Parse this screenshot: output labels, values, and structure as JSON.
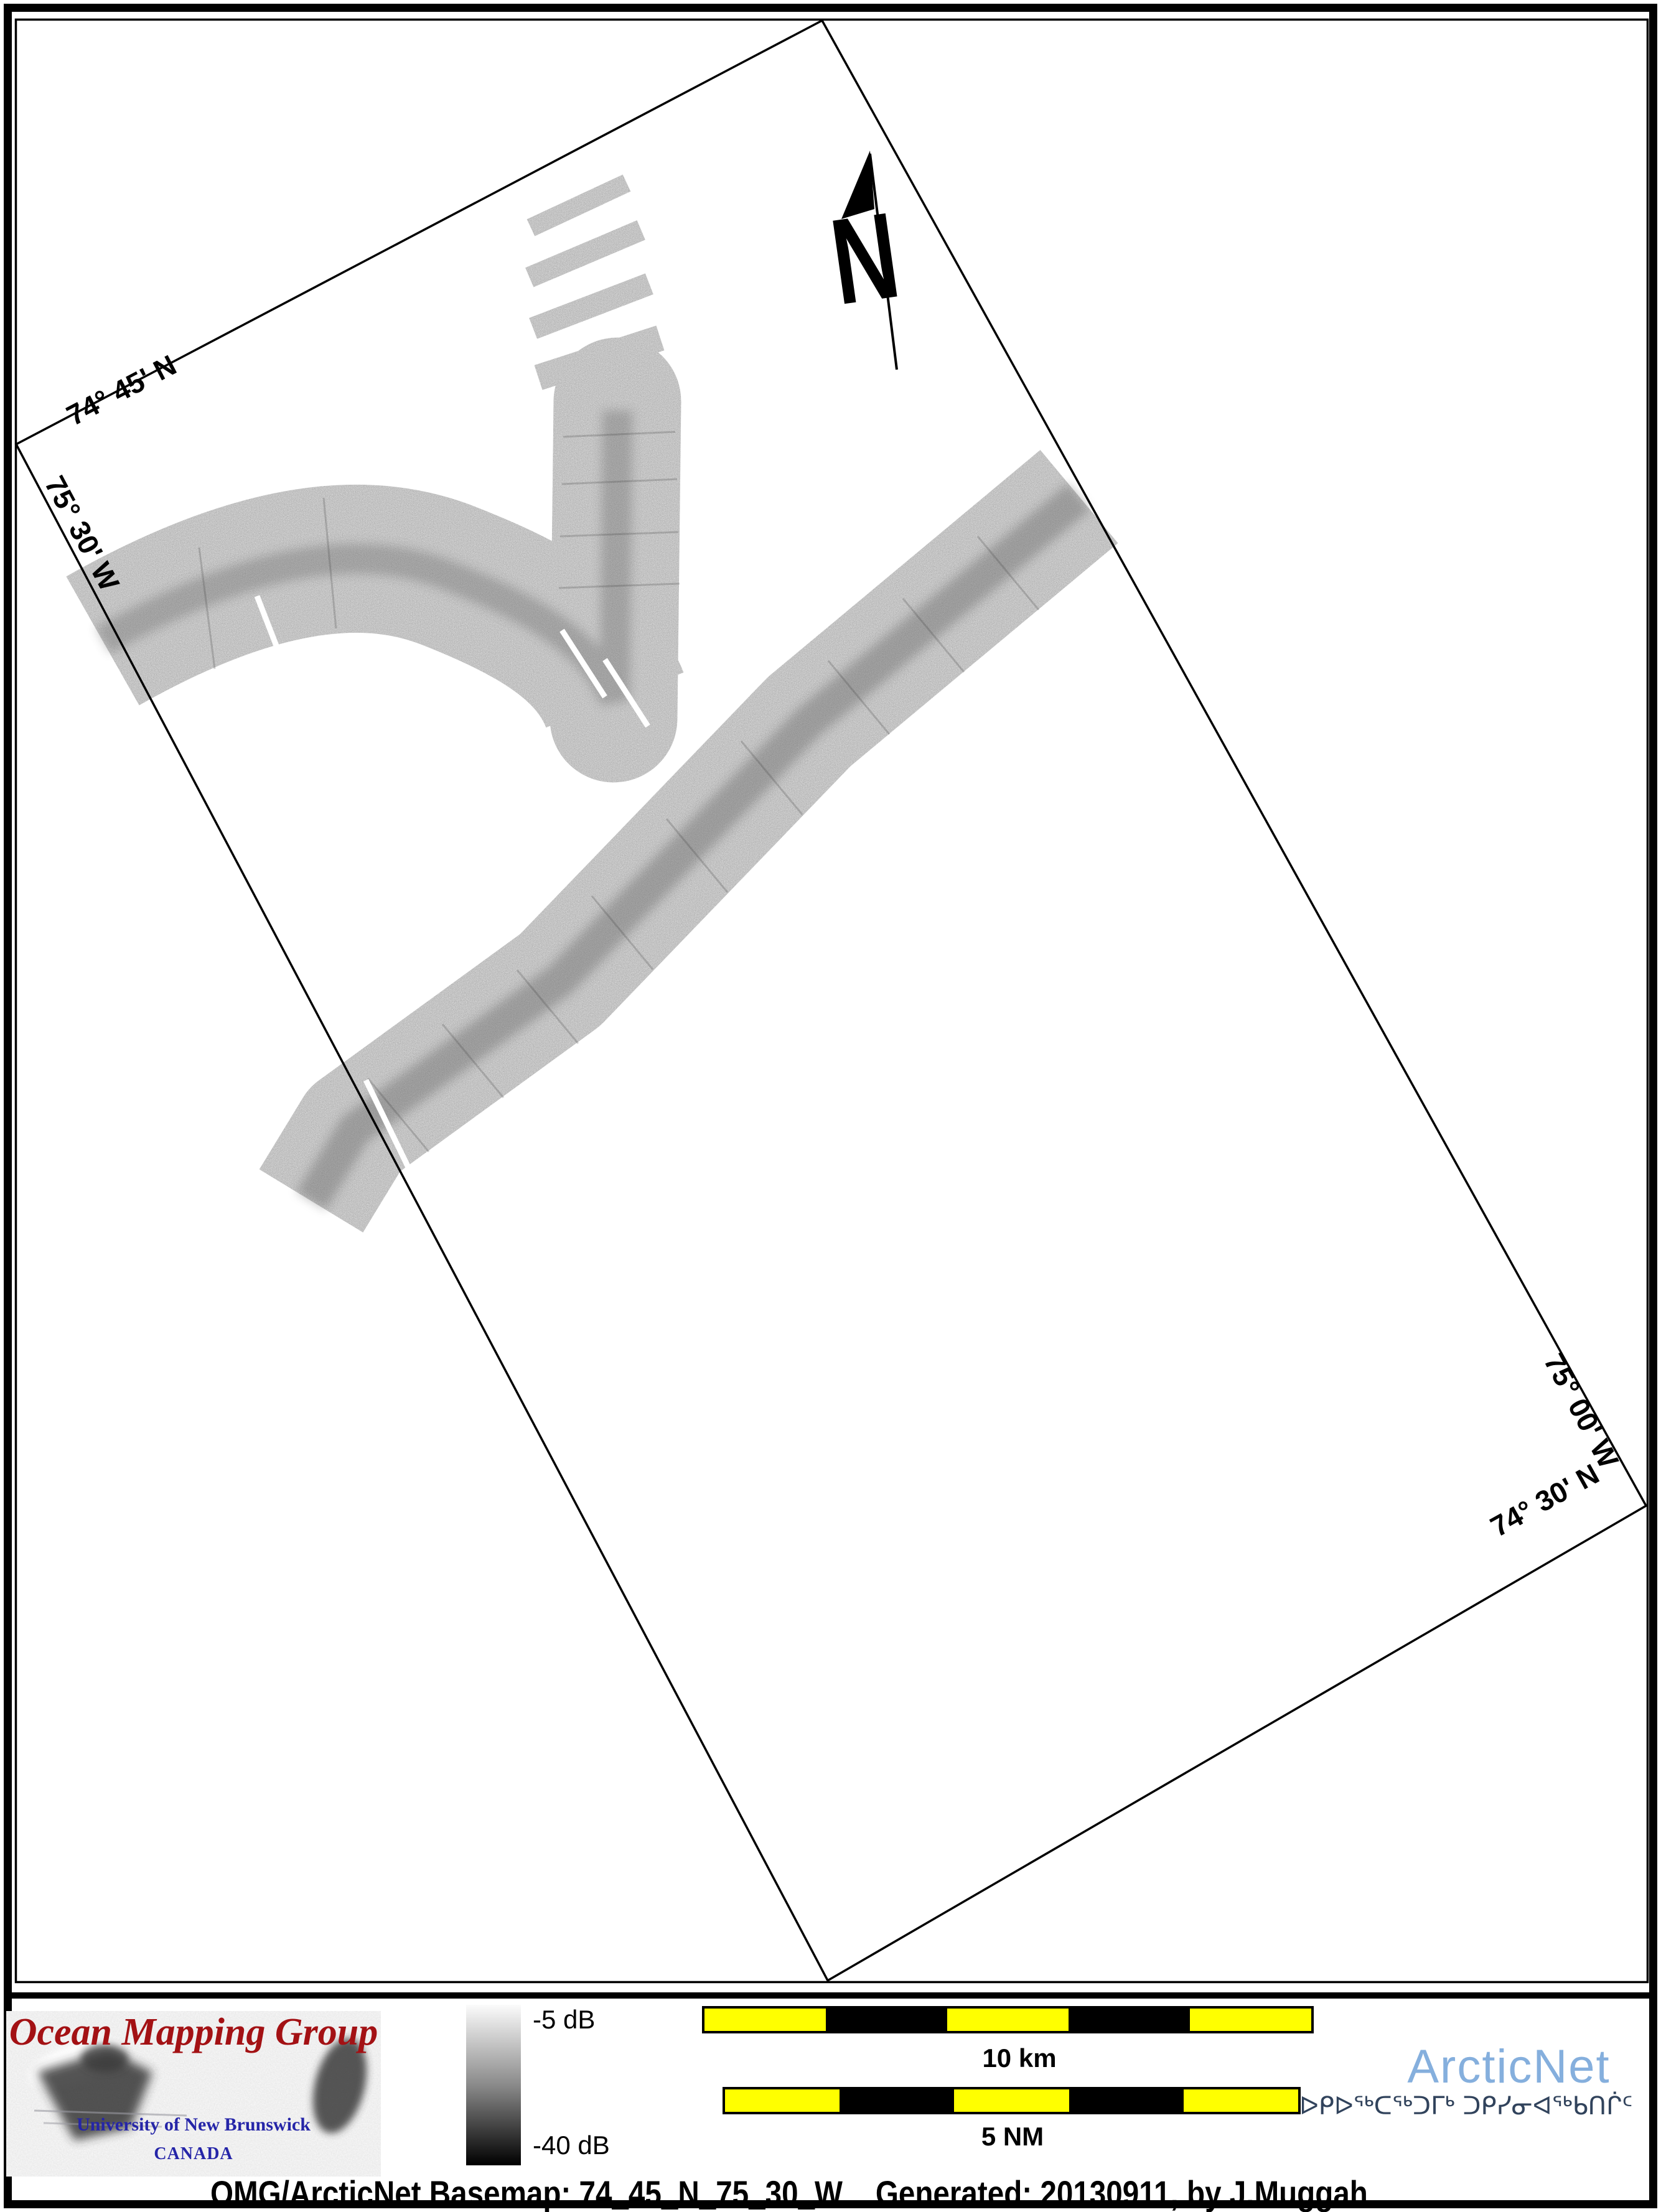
{
  "map": {
    "graticule_labels": {
      "top_lat": "74° 45' N",
      "left_lon": "75° 30' W",
      "right_lon": "75° 00' W",
      "bottom_lat": "74° 30' N"
    },
    "north_label": "N"
  },
  "legend": {
    "omg_logo": {
      "title": "Ocean Mapping Group",
      "subtitle": "University of New Brunswick",
      "country": "CANADA"
    },
    "colorbar": {
      "max_label": "-5 dB",
      "min_label": "-40 dB"
    },
    "scalebars": {
      "km_label": "10 km",
      "nm_label": "5 NM"
    },
    "arcticnet": {
      "name": "ArcticNet",
      "inuktitut": "ᐅᑭᐅᖅᑕᖅᑐᒥᒃ ᑐᑭᓯᓂᐊᖅᑲᑎᒌᑦ"
    }
  },
  "footer": {
    "caption": "OMG/ArcticNet Basemap: 74_45_N_75_30_W    Generated: 20130911, by J.Muggah"
  },
  "colors": {
    "scalebar_yellow": "#ffff00",
    "arcticnet_blue": "#85afdd",
    "inuktitut_navy": "#31435c",
    "omg_red": "#a31114",
    "unb_blue": "#2525a8"
  }
}
